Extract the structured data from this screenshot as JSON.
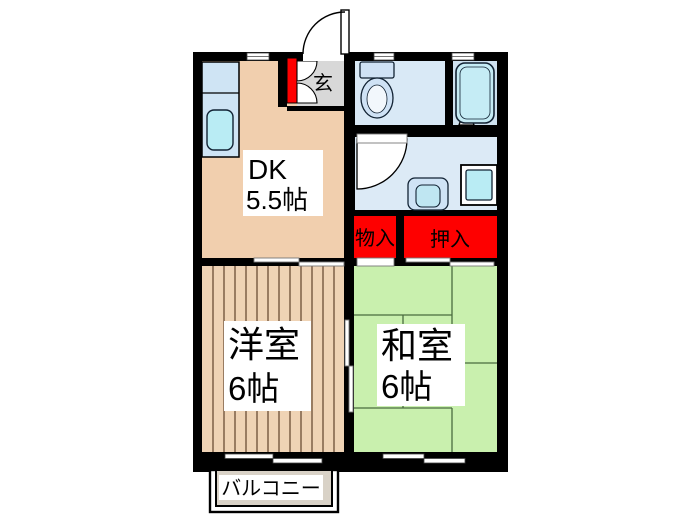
{
  "plan": {
    "rooms": {
      "dk": {
        "name": "DK",
        "size": "5.5帖"
      },
      "western": {
        "name": "洋室",
        "size": "6帖"
      },
      "japanese": {
        "name": "和室",
        "size": "6帖"
      }
    },
    "spaces": {
      "entrance_label": "玄",
      "storage_label": "物入",
      "closet_label": "押入",
      "balcony_label": "バルコニー"
    },
    "colors": {
      "wall": "#000000",
      "dk_floor": "#f1cfae",
      "western_floor": "#efd3b5",
      "tatami_green": "#c9f0ae",
      "toilet_floor": "#d9e9f6",
      "bath_floor": "#cfe2f0",
      "washroom_floor": "#dceaf6",
      "closet_red": "#fe0000",
      "entrance_gray": "#d8d8d8",
      "balcony_gray": "#d9d2c7",
      "fixture_cyan": "#b9ecf4",
      "fixture_blue": "#cfe3f5"
    }
  }
}
